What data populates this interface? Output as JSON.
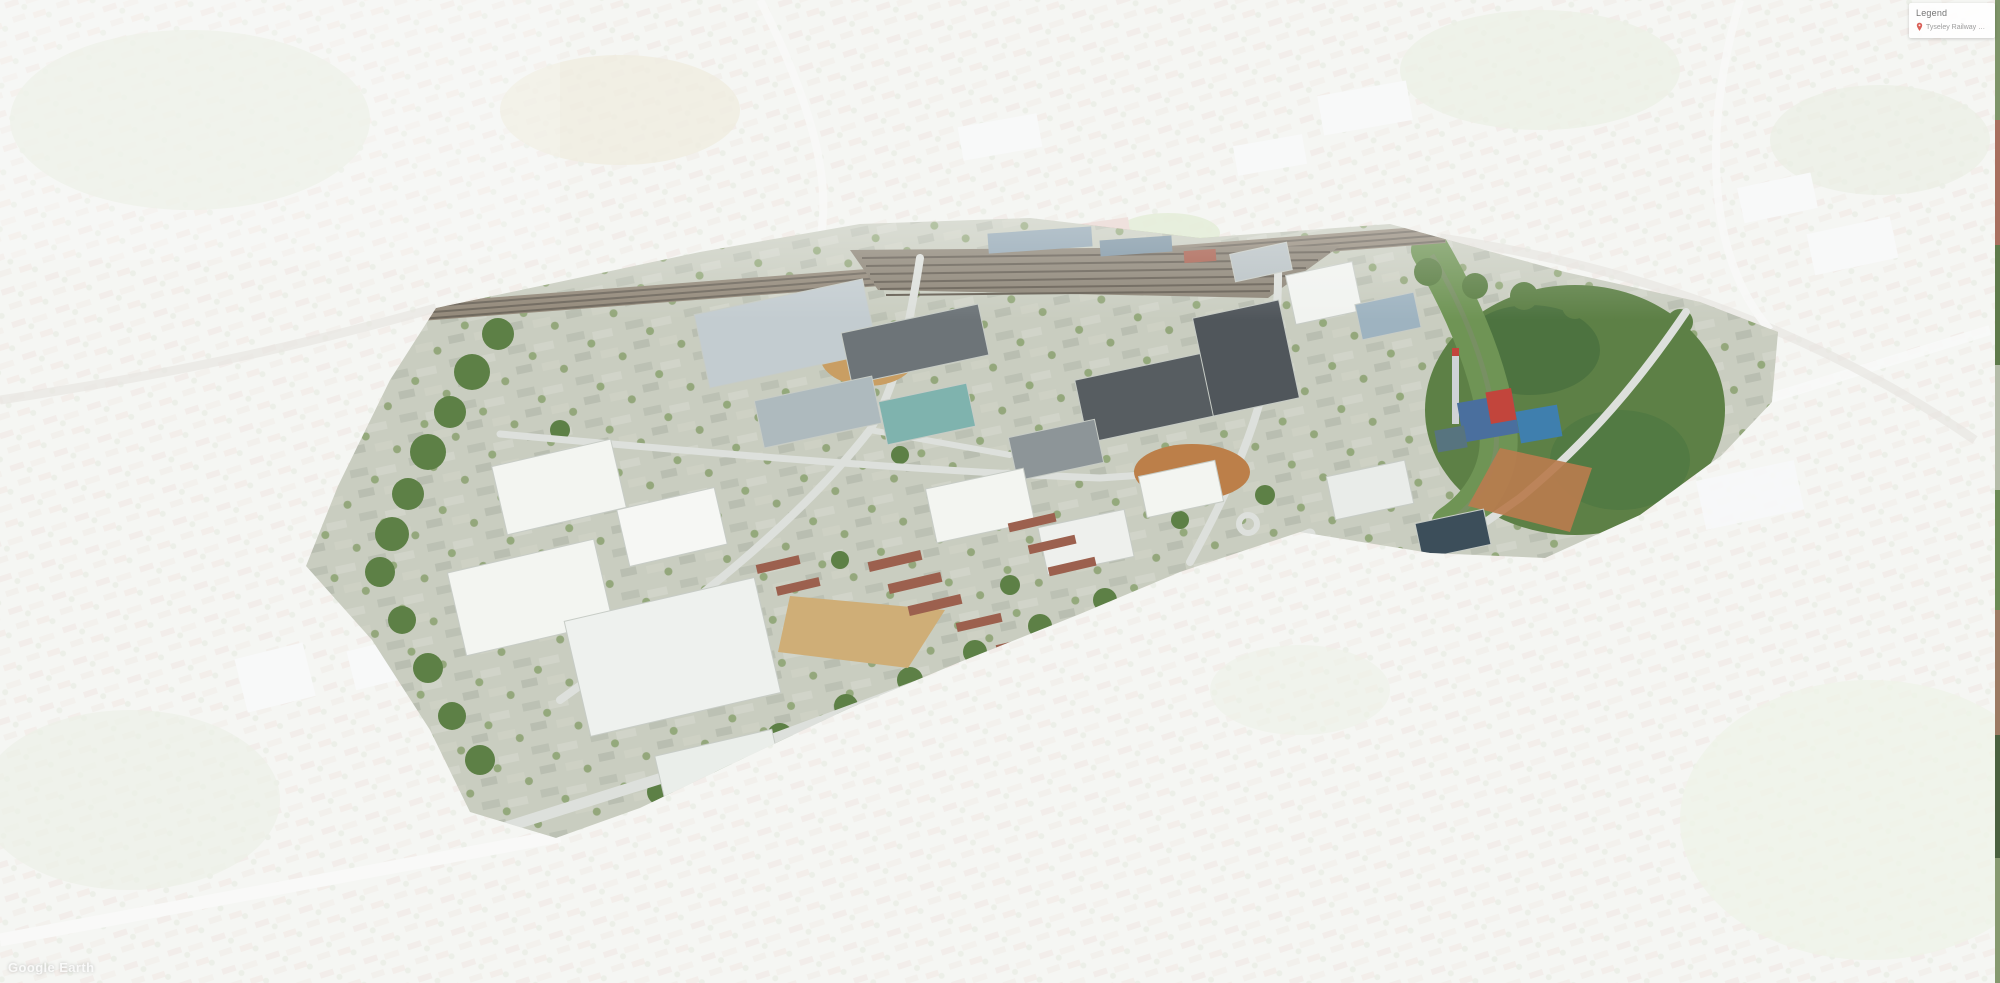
{
  "app": {
    "name": "Google Earth"
  },
  "legend": {
    "title": "Legend",
    "items": [
      {
        "icon": "map-pin-icon",
        "label": "Tyseley Railway Station",
        "pin_color": "#d95f57"
      }
    ],
    "panel_bg": "#ffffff",
    "title_color": "#757575",
    "label_color": "#9c9c9c"
  },
  "watermark": {
    "text": "Google Earth"
  },
  "map": {
    "view": "oblique-aerial-3d",
    "veil_color": "#ffffff",
    "veil_opacity": "0.74",
    "palette": {
      "ground": "#c9cdc0",
      "faded_ground": "#d8dacf",
      "warehouse_white": "#f3f5f1",
      "factory_dark_roof": "#575d61",
      "teal_roof": "#7fb3ae",
      "plant_blue": "#3f7fae",
      "plant_red": "#c2453c",
      "woodland_green": "#5d8046",
      "dirt_brown": "#bc7f49",
      "dirt_sand": "#cfae77",
      "road_gray": "#dde0dc",
      "rail_brown": "#93897a",
      "housing_red": "#9c604e"
    }
  }
}
